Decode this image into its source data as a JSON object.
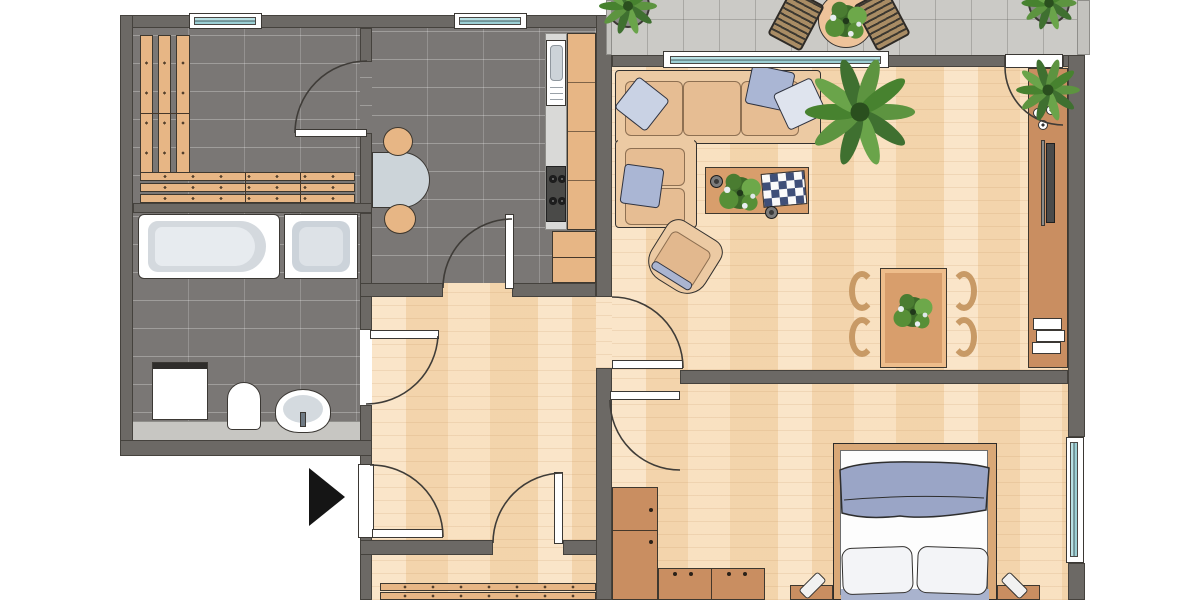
{
  "document": {
    "type": "floor-plan",
    "title": "Apartment floor plan (top-down architectural drawing, no text labels)"
  },
  "palette": {
    "wall": "#6c6965",
    "outline": "#3b3834",
    "dark_tile_floor": "#7a7775",
    "parquet_floor": "#f8deba",
    "balcony_paving": "#cbcac6",
    "wood_furniture": "#e7b685",
    "cabinet_brown": "#c98e61",
    "fixture_white": "#ffffff",
    "fixture_gray": "#d4d9de",
    "window_glass": "#a9d8dc",
    "textile_blue": "#9aa5c6",
    "pillow_light": "#eceff4",
    "plant_green": "#5d9440",
    "arrow_black": "#151515"
  },
  "rooms": [
    {
      "id": "pantry",
      "label": "storage room with corner wall benches",
      "floor": "dark tile"
    },
    {
      "id": "kitchen",
      "label": "kitchen",
      "floor": "dark tile"
    },
    {
      "id": "bathroom",
      "label": "bathroom",
      "floor": "dark tile"
    },
    {
      "id": "hallway",
      "label": "hallway",
      "floor": "parquet"
    },
    {
      "id": "living-room",
      "label": "living room",
      "floor": "parquet"
    },
    {
      "id": "bedroom",
      "label": "bedroom",
      "floor": "parquet"
    },
    {
      "id": "bottom-room",
      "label": "room at lower edge (cut off by image border)",
      "floor": "parquet"
    },
    {
      "id": "balcony",
      "label": "balcony",
      "floor": "stone paving"
    }
  ],
  "furniture": {
    "pantry": [
      "L-shaped slatted wall bench",
      "window"
    ],
    "kitchen": [
      "small table with two stools",
      "sink unit",
      "stove with four burners",
      "tall counter cabinets",
      "base cabinet",
      "window"
    ],
    "bathroom": [
      "bathtub",
      "shower tray",
      "washing machine",
      "toilet",
      "wash basin"
    ],
    "living-room": [
      "corner sofa with four cushions",
      "coffee table with plant, chessboard and two bowls",
      "rotated armchair",
      "large potted palm",
      "dining table with four chairs and plant",
      "sideboard with plant, bowls, TV and books"
    ],
    "bedroom": [
      "double bed with blue blanket and two pillows",
      "two nightstands with lamps",
      "corner wardrobe units"
    ],
    "bottom-room": [
      "slatted bench (cut off)"
    ],
    "balcony": [
      "round table with plant",
      "two slatted chairs",
      "two corner planters"
    ]
  },
  "doors": [
    "pantry door (from kitchen)",
    "kitchen door (from hallway)",
    "bathroom door (to hallway)",
    "apartment entrance door with black arrow marker",
    "bottom-room door (from hallway)",
    "living-room door (from hallway)",
    "bedroom door",
    "balcony door (from living room)"
  ],
  "windows": [
    "pantry window (top wall)",
    "kitchen window (top wall)",
    "living-room window to balcony",
    "bedroom window (right wall)"
  ]
}
